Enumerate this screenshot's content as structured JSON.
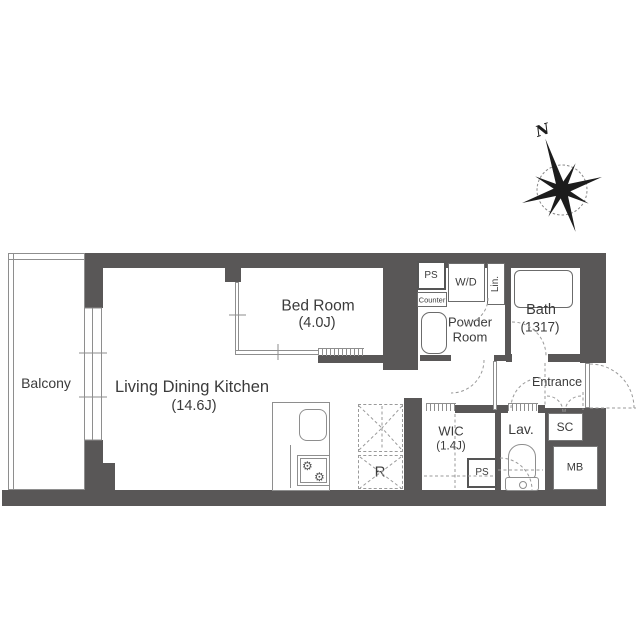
{
  "colors": {
    "wall": "#595757",
    "line": "#8e8e8e",
    "dash": "#9a9a9a",
    "text": "#3b3b3b"
  },
  "compass": {
    "north": "N"
  },
  "rooms": {
    "balcony": {
      "name": "Balcony"
    },
    "living": {
      "name": "Living Dining Kitchen",
      "size": "(14.6J)"
    },
    "bedroom": {
      "name": "Bed Room",
      "size": "(4.0J)"
    },
    "powder": {
      "line1": "Powder",
      "line2": "Room"
    },
    "bath": {
      "name": "Bath",
      "size": "(1317)"
    },
    "wic": {
      "name": "WIC",
      "size": "(1.4J)"
    },
    "lavatory": {
      "name": "Lav."
    },
    "entrance": {
      "name": "Entrance"
    }
  },
  "labels": {
    "ps_upper": "PS",
    "counter": "Counter",
    "washer_dryer": "W/D",
    "linen": "Lin.",
    "shoe_closet": "SC",
    "meter_box": "MB",
    "ps_lower": "PS",
    "refrigerator": "R"
  },
  "icons": {
    "burner": "⚙"
  }
}
